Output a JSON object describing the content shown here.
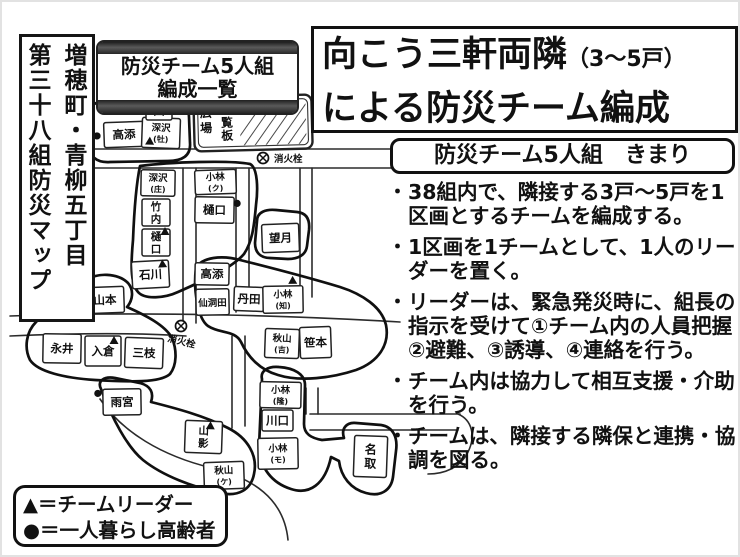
{
  "page": {
    "bg": "#ffffff",
    "ink": "#111111"
  },
  "map_area_label": {
    "line1": "増穂町・青柳五丁目",
    "line2": "第三十八組防災マップ"
  },
  "banner": {
    "line1": "防災チーム5人組",
    "line2": "編成一覧"
  },
  "title": {
    "line1_main": "向こう三軒両隣",
    "line1_paren": "（3～5戸）",
    "line2": "による防災チーム編成"
  },
  "rules": {
    "header": "防災チーム5人組　きまり",
    "bullet_char": "・",
    "items": [
      "38組内で、隣接する3戸～5戸を1区画とするチームを編成する。",
      "1区画を1チームとして、1人のリーダーを置く。",
      "リーダーは、緊急発災時に、組長の指示を受けて①チーム内の人員把握②避難、③誘導、④連絡を行う。",
      "チーム内は協力して相互支援・介助を行う。",
      "チームは、隣接する隣保と連携・協調を図る。"
    ]
  },
  "legend": {
    "leader": "▲＝チームリーダー",
    "elderly": "●＝一人暮らし高齢者"
  },
  "map": {
    "hydrant_label": "消火栓",
    "plaza": {
      "x": 194,
      "y": 96,
      "w": 118,
      "h": 54,
      "rot": -1.5,
      "label1": "広場",
      "label2": "回覧板"
    },
    "hydrants": [
      {
        "x": 263,
        "y": 158,
        "lx": 274,
        "ly": 162,
        "rot": 0
      },
      {
        "x": 181,
        "y": 326,
        "lx": 167,
        "ly": 341,
        "rot": 14
      }
    ],
    "roads": [
      "M88 149 L478 149",
      "M88 168 L478 168",
      "M183 168 L183 321",
      "M196 168 L196 323",
      "M236 168 L236 312",
      "M249 168 L249 310",
      "M300 168 L300 299",
      "M312 168 L312 297",
      "M10 316 C150 311 300 316 400 322",
      "M10 336 C80 333 140 333 186 336",
      "M232 336 L232 428",
      "M245 336 L245 426",
      "M306 388 L306 414",
      "M318 388 L318 414",
      "M310 414 L460 414",
      "M310 430 L458 430",
      "M458 414 C472 420 476 436 468 452 C460 468 444 474 428 474",
      "M100 399 C122 432 162 456 212 468 C252 478 284 498 288 540"
    ],
    "team_outlines": [
      "M90 116 C88 104 98 100 112 101 L170 99 C183 98 189 106 189 117 L190 143 C191 156 182 161 168 161 L110 162 C96 163 89 156 89 144 Z",
      "M140 166 C170 162 230 160 250 164 C258 168 258 190 256 205 C254 228 252 242 244 254 C232 268 205 280 178 292 C165 298 145 300 138 292 C130 283 131 262 133 240 C134 215 136 185 140 166 Z",
      "M257 221 C257 212 266 209 276 210 L297 212 C307 213 310 220 309 230 L307 246 C306 255 298 259 288 259 L270 258 C260 258 255 252 255 243 Z",
      "M86 281 C96 272 118 273 128 283 C134 290 133 300 127 307 C145 315 165 325 172 338 C177 350 177 365 170 374 C160 383 130 382 95 380 C65 378 38 372 30 360 C24 348 26 332 36 322 C48 310 66 292 86 281 Z",
      "M196 268 C202 257 222 255 240 260 C272 268 310 278 340 287 C362 294 382 307 386 325 C390 345 378 362 356 370 C332 378 300 382 278 375 C260 370 248 357 241 342 C235 330 220 334 208 326 C198 319 193 290 196 268 Z",
      "M101 389 C97 381 104 376 115 378 L140 383 C151 386 154 393 151 402 C175 408 205 416 228 428 C248 438 258 456 254 474 C251 490 238 497 220 493 C193 487 163 476 143 460 C127 447 112 418 101 389 Z",
      "M262 379 C260 371 268 366 279 367 C294 368 305 374 305 385 L304 424 C304 434 311 438 322 440 L344 438 C341 429 346 422 356 423 L381 425 C393 427 398 437 396 451 L393 477 C391 491 380 497 366 493 C351 489 341 477 339 461 L331 457 C325 485 309 495 291 489 C272 483 260 468 259 447 Z"
    ],
    "houses": [
      {
        "name": "高添",
        "x": 104,
        "y": 122,
        "w": 40,
        "h": 25,
        "style": "h",
        "marker": "elderly",
        "mx": 97,
        "my": 135,
        "tilt": -2
      },
      {
        "name": "深沢(牡)",
        "x": 142,
        "y": 118,
        "w": 38,
        "h": 30,
        "style": "p",
        "marker": "leader",
        "mx": 150,
        "my": 145,
        "tilt": 2
      },
      {
        "name": "田",
        "x": 146,
        "y": 101,
        "w": 26,
        "h": 19,
        "style": "h",
        "tilt": 0
      },
      {
        "name": "深沢(庄)",
        "x": 141,
        "y": 170,
        "w": 34,
        "h": 26,
        "style": "p",
        "tilt": 1
      },
      {
        "name": "竹内",
        "x": 142,
        "y": 199,
        "w": 28,
        "h": 27,
        "style": "v",
        "tilt": 0
      },
      {
        "name": "樋口",
        "x": 142,
        "y": 229,
        "w": 28,
        "h": 27,
        "style": "v",
        "marker": "leader",
        "mx": 165,
        "my": 235,
        "tilt": 0
      },
      {
        "name": "石川",
        "x": 132,
        "y": 261,
        "w": 37,
        "h": 27,
        "style": "h",
        "marker": "leader",
        "mx": 163,
        "my": 268,
        "tilt": -3
      },
      {
        "name": "小林(ク)",
        "x": 195,
        "y": 170,
        "w": 41,
        "h": 24,
        "style": "p",
        "tilt": -2
      },
      {
        "name": "樋口",
        "x": 195,
        "y": 197,
        "w": 39,
        "h": 26,
        "style": "h",
        "marker": "elderly",
        "mx": 237,
        "my": 203,
        "tilt": 1
      },
      {
        "name": "望月",
        "x": 262,
        "y": 224,
        "w": 37,
        "h": 28,
        "style": "h",
        "tilt": -2
      },
      {
        "name": "高添",
        "x": 195,
        "y": 263,
        "w": 34,
        "h": 22,
        "style": "h",
        "tilt": 1
      },
      {
        "name": "仙洞田",
        "x": 196,
        "y": 289,
        "w": 33,
        "h": 26,
        "style": "h",
        "tilt": -1
      },
      {
        "name": "丹田",
        "x": 234,
        "y": 287,
        "w": 30,
        "h": 24,
        "style": "h",
        "tilt": 2
      },
      {
        "name": "小林(知)",
        "x": 263,
        "y": 286,
        "w": 40,
        "h": 27,
        "style": "p",
        "marker": "leader",
        "mx": 293,
        "my": 284,
        "tilt": -1
      },
      {
        "name": "秋山(吉)",
        "x": 265,
        "y": 329,
        "w": 34,
        "h": 29,
        "style": "p",
        "tilt": 2
      },
      {
        "name": "笹本",
        "x": 300,
        "y": 327,
        "w": 31,
        "h": 31,
        "style": "h",
        "tilt": -2
      },
      {
        "name": "山本",
        "x": 86,
        "y": 287,
        "w": 38,
        "h": 26,
        "style": "h",
        "marker": "elderly",
        "mx": 79,
        "my": 293,
        "tilt": -2
      },
      {
        "name": "永井",
        "x": 43,
        "y": 334,
        "w": 38,
        "h": 29,
        "style": "h",
        "tilt": 1
      },
      {
        "name": "入倉",
        "x": 85,
        "y": 336,
        "w": 36,
        "h": 30,
        "style": "h",
        "marker": "leader",
        "mx": 114,
        "my": 344,
        "tilt": 0
      },
      {
        "name": "三枝",
        "x": 125,
        "y": 338,
        "w": 38,
        "h": 30,
        "style": "h",
        "tilt": 2
      },
      {
        "name": "雨宮",
        "x": 103,
        "y": 389,
        "w": 38,
        "h": 26,
        "style": "h",
        "marker": "elderly",
        "mx": 98,
        "my": 393,
        "tilt": -1
      },
      {
        "name": "山影",
        "x": 185,
        "y": 421,
        "w": 37,
        "h": 32,
        "style": "v",
        "marker": "leader",
        "mx": 210,
        "my": 429,
        "tilt": 2
      },
      {
        "name": "秋山(ケ)",
        "x": 204,
        "y": 462,
        "w": 40,
        "h": 27,
        "style": "p",
        "tilt": -2
      },
      {
        "name": "小林(隆)",
        "x": 260,
        "y": 382,
        "w": 41,
        "h": 26,
        "style": "p",
        "tilt": 1
      },
      {
        "name": "川口",
        "x": 262,
        "y": 410,
        "w": 31,
        "h": 21,
        "style": "h",
        "tilt": 0
      },
      {
        "name": "小林(モ)",
        "x": 258,
        "y": 438,
        "w": 40,
        "h": 31,
        "style": "p",
        "tilt": -1
      },
      {
        "name": "名取",
        "x": 354,
        "y": 436,
        "w": 33,
        "h": 41,
        "style": "v",
        "tilt": 2
      }
    ]
  }
}
